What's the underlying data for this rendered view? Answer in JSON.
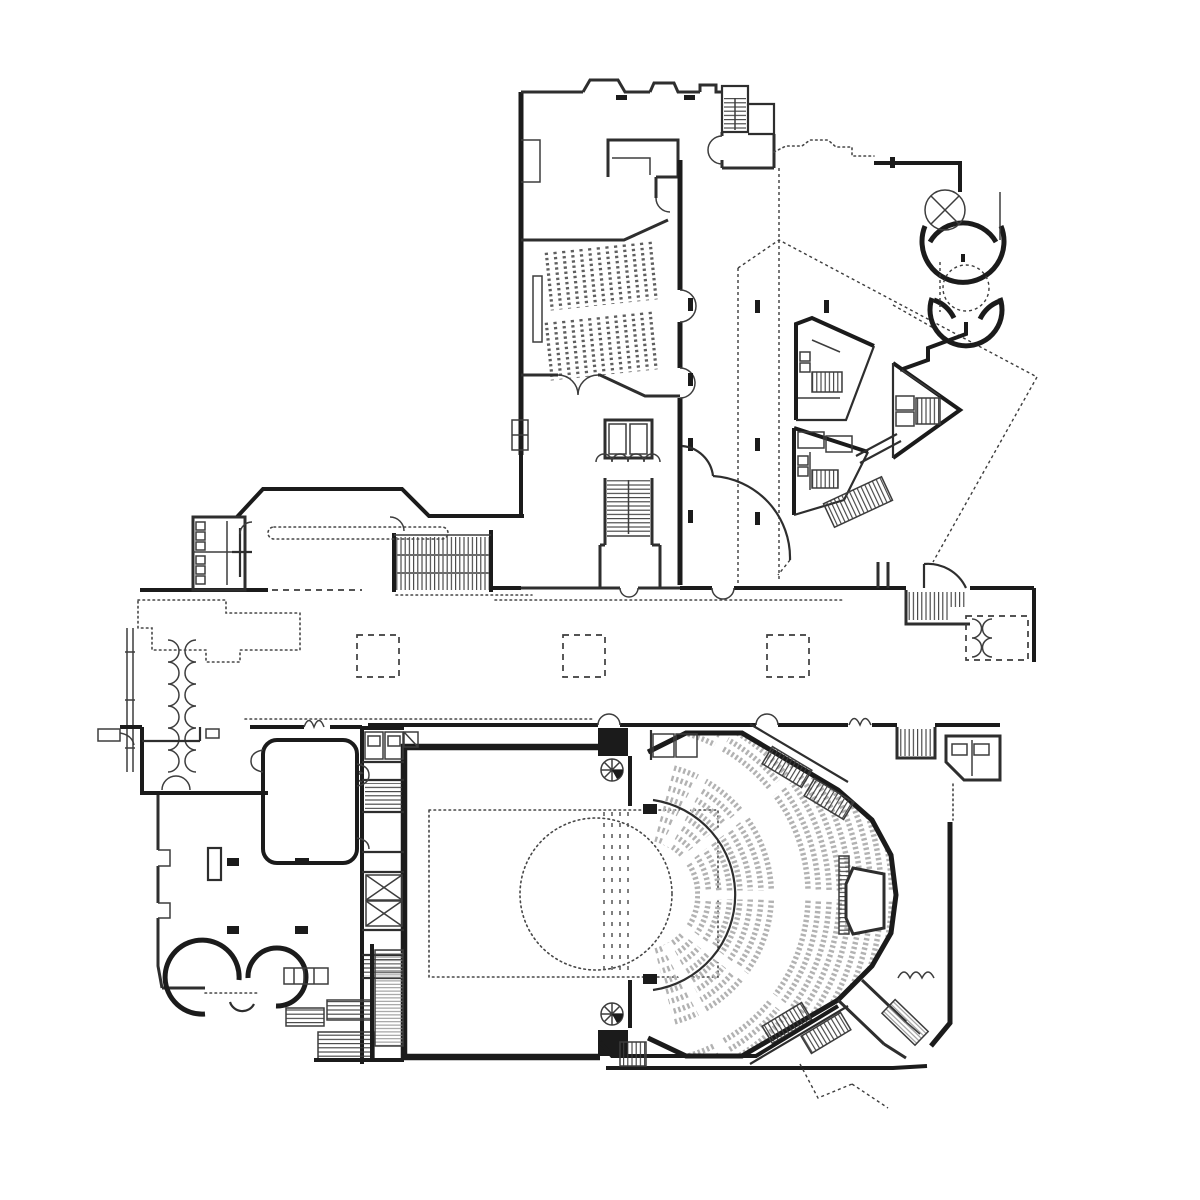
{
  "document": {
    "kind": "architectural-floor-plan",
    "subject": "performing-arts-center-ground-floor",
    "viewbox": "0 0 1200 1200",
    "visible_text": []
  },
  "colors": {
    "background": "#ffffff",
    "wall": "#1b1b1b",
    "wall_medium": "#2e2e2e",
    "thin_line": "#3d3d3d",
    "dotted": "#474747",
    "hatch": "#3c3c3c",
    "hatch_gray": "#8f8f8f",
    "seat_fan": "#b2b2b2",
    "seat_rows": "#5f5f5f"
  },
  "inventory": {
    "small_hall_seat_banks": 2,
    "small_hall_rows_per_bank": 13,
    "auditorium_front_seat_arcs": 8,
    "auditorium_rear_seat_arcs": 9,
    "foyer_dashed_columns": 3,
    "circular_pods": 2,
    "triangular_pods": 3,
    "spiral_stairs": 2,
    "revolving_stage_circles": 1
  }
}
